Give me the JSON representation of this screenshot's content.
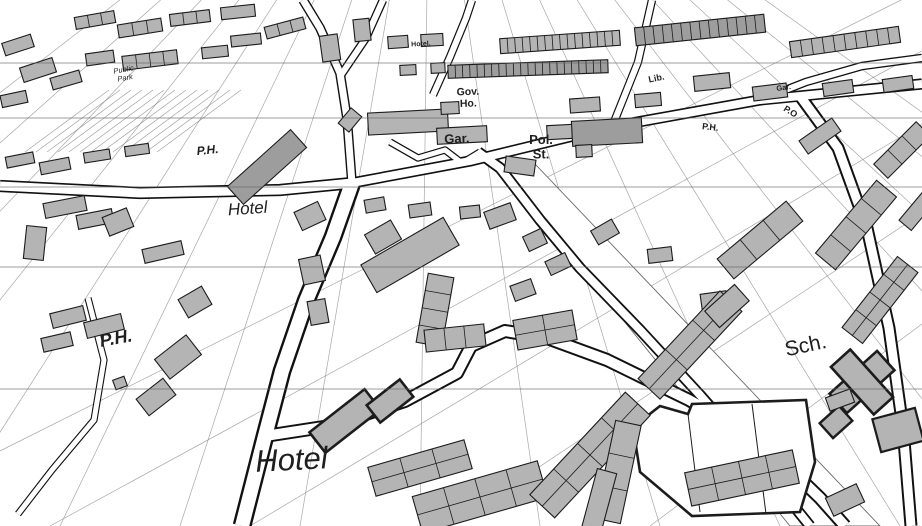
{
  "canvas": {
    "width": 922,
    "height": 526,
    "background": "#ffffff"
  },
  "colors": {
    "building_fill": "#b4b4b4",
    "building_fill_dark": "#9d9d9d",
    "building_stroke": "#1c1c1c",
    "road_casing": "#111111",
    "road_fill": "#ffffff",
    "parcel_line": "#8b8b8b",
    "grid_line": "#5f5f5f",
    "band_edge": "#6a6a6a",
    "label_dark": "#1f1f1f",
    "label_gray": "#3b3b3b"
  },
  "labels": [
    {
      "id": "public-park",
      "lines": [
        "Public",
        "Park"
      ],
      "x": 124,
      "y": 72,
      "size": 7.5,
      "rot": -10,
      "italic": true,
      "bold": false,
      "gray": true
    },
    {
      "id": "hotel-top",
      "lines": [
        "Hotel."
      ],
      "x": 421,
      "y": 46,
      "size": 7,
      "rot": -3,
      "italic": false,
      "bold": true,
      "gray": true
    },
    {
      "id": "gov-ho",
      "lines": [
        "Gov.",
        "Ho."
      ],
      "x": 468,
      "y": 95,
      "size": 10.5,
      "rot": -2,
      "italic": false,
      "bold": true,
      "gray": false
    },
    {
      "id": "lib",
      "lines": [
        "Lib."
      ],
      "x": 657,
      "y": 81,
      "size": 9,
      "rot": -12,
      "italic": false,
      "bold": true,
      "gray": false
    },
    {
      "id": "gar-small",
      "lines": [
        "Gar."
      ],
      "x": 784,
      "y": 90,
      "size": 7.5,
      "rot": -8,
      "italic": false,
      "bold": true,
      "gray": true
    },
    {
      "id": "po",
      "lines": [
        "P.O"
      ],
      "x": 789,
      "y": 114,
      "size": 9,
      "rot": 32,
      "italic": false,
      "bold": true,
      "gray": false
    },
    {
      "id": "ph-right",
      "lines": [
        "P.H."
      ],
      "x": 710,
      "y": 130,
      "size": 9,
      "rot": 6,
      "italic": false,
      "bold": true,
      "gray": false
    },
    {
      "id": "gar",
      "lines": [
        "Gar."
      ],
      "x": 457,
      "y": 143,
      "size": 13,
      "rot": -2,
      "italic": false,
      "bold": true,
      "gray": false
    },
    {
      "id": "pol-st",
      "lines": [
        "Pol.",
        "St."
      ],
      "x": 541,
      "y": 144,
      "size": 13,
      "rot": 0,
      "italic": false,
      "bold": true,
      "gray": false
    },
    {
      "id": "ph-left",
      "lines": [
        "P.H."
      ],
      "x": 208,
      "y": 154,
      "size": 12,
      "rot": -6,
      "italic": true,
      "bold": true,
      "gray": false
    },
    {
      "id": "hotel-mid",
      "lines": [
        "Hotel"
      ],
      "x": 248,
      "y": 214,
      "size": 17,
      "rot": -4,
      "italic": true,
      "bold": false,
      "gray": false
    },
    {
      "id": "ph-bottom",
      "lines": [
        "P.H."
      ],
      "x": 117,
      "y": 344,
      "size": 18,
      "rot": -10,
      "italic": true,
      "bold": true,
      "gray": false
    },
    {
      "id": "sch",
      "lines": [
        "Sch."
      ],
      "x": 807,
      "y": 352,
      "size": 21,
      "rot": -12,
      "italic": false,
      "bold": false,
      "gray": false
    },
    {
      "id": "hotel-bottom",
      "lines": [
        "Hotel"
      ],
      "x": 292,
      "y": 470,
      "size": 31,
      "rot": -3,
      "italic": true,
      "bold": false,
      "gray": false
    }
  ],
  "gridlines": [
    63,
    118,
    187,
    267,
    389
  ],
  "parcel_fan": {
    "vp": [
      430,
      -240
    ],
    "targets_y": 526,
    "targets_x": [
      -560,
      -430,
      -300,
      -180,
      -60,
      60,
      180,
      300,
      420,
      540,
      660,
      780,
      900,
      1020,
      1140,
      1260,
      1380,
      1500
    ]
  },
  "parcel_fan2": {
    "vp": [
      2300,
      -700
    ],
    "targets_y": 526,
    "targets_x": [
      -150,
      50,
      250,
      450,
      650
    ]
  },
  "park_stripes": {
    "x0": 25,
    "y0": 152,
    "dx": 84,
    "dy": -62,
    "count": 13,
    "step": 11
  },
  "band": {
    "pts": [
      [
        500,
        168
      ],
      [
        535,
        164
      ],
      [
        880,
        526
      ],
      [
        790,
        526
      ]
    ]
  },
  "roads": [
    {
      "pts": [
        [
          0,
          186
        ],
        [
          140,
          193
        ],
        [
          280,
          190
        ],
        [
          352,
          183
        ]
      ],
      "w": 9,
      "c": 1.6
    },
    {
      "pts": [
        [
          352,
          183
        ],
        [
          470,
          161
        ],
        [
          610,
          127
        ],
        [
          760,
          100
        ],
        [
          922,
          84
        ]
      ],
      "w": 8,
      "c": 1.6
    },
    {
      "pts": [
        [
          352,
          183
        ],
        [
          347,
          118
        ],
        [
          340,
          73
        ],
        [
          320,
          28
        ],
        [
          303,
          0
        ]
      ],
      "w": 7,
      "c": 1.4
    },
    {
      "pts": [
        [
          341,
          75
        ],
        [
          366,
          38
        ],
        [
          383,
          0
        ]
      ],
      "w": 6,
      "c": 1.3
    },
    {
      "pts": [
        [
          352,
          183
        ],
        [
          333,
          237
        ],
        [
          306,
          301
        ],
        [
          282,
          371
        ],
        [
          265,
          436
        ],
        [
          242,
          526
        ]
      ],
      "w": 14,
      "c": 2.4
    },
    {
      "pts": [
        [
          265,
          436
        ],
        [
          330,
          426
        ],
        [
          405,
          401
        ],
        [
          457,
          373
        ],
        [
          471,
          346
        ],
        [
          505,
          331
        ],
        [
          547,
          338
        ],
        [
          607,
          360
        ],
        [
          689,
          400
        ],
        [
          760,
          440
        ],
        [
          820,
          498
        ],
        [
          845,
          526
        ]
      ],
      "w": 10,
      "c": 2.0
    },
    {
      "pts": [
        [
          478,
          152
        ],
        [
          500,
          168
        ],
        [
          540,
          220
        ],
        [
          580,
          268
        ],
        [
          640,
          330
        ],
        [
          700,
          395
        ],
        [
          755,
          458
        ],
        [
          810,
          526
        ]
      ],
      "w": 8,
      "c": 1.8
    },
    {
      "pts": [
        [
          800,
          96
        ],
        [
          838,
          148
        ],
        [
          867,
          228
        ],
        [
          889,
          328
        ],
        [
          903,
          428
        ],
        [
          911,
          526
        ]
      ],
      "w": 9,
      "c": 2.0
    },
    {
      "pts": [
        [
          760,
          100
        ],
        [
          806,
          82
        ],
        [
          862,
          66
        ],
        [
          922,
          58
        ]
      ],
      "w": 6,
      "c": 1.3
    },
    {
      "pts": [
        [
          88,
          298
        ],
        [
          104,
          360
        ],
        [
          94,
          420
        ],
        [
          52,
          470
        ],
        [
          18,
          514
        ]
      ],
      "w": 5,
      "c": 1.1
    },
    {
      "pts": [
        [
          433,
          95
        ],
        [
          450,
          57
        ],
        [
          466,
          18
        ],
        [
          472,
          0
        ]
      ],
      "w": 6,
      "c": 1.2
    },
    {
      "pts": [
        [
          612,
          127
        ],
        [
          638,
          62
        ],
        [
          652,
          0
        ]
      ],
      "w": 6,
      "c": 1.2
    },
    {
      "pts": [
        [
          390,
          142
        ],
        [
          418,
          158
        ],
        [
          445,
          150
        ],
        [
          462,
          163
        ],
        [
          480,
          152
        ]
      ],
      "w": 5,
      "c": 1.2
    }
  ],
  "polygons": [
    {
      "pts": [
        [
          633,
          427
        ],
        [
          660,
          406
        ],
        [
          688,
          414
        ],
        [
          692,
          404
        ],
        [
          806,
          400
        ],
        [
          815,
          462
        ],
        [
          800,
          512
        ],
        [
          692,
          516
        ],
        [
          640,
          472
        ]
      ],
      "sw": 2.6,
      "inner": [
        [
          [
            688,
            414
          ],
          [
            700,
            512
          ]
        ],
        [
          [
            752,
            404
          ],
          [
            766,
            514
          ]
        ]
      ]
    }
  ],
  "buildings": [
    [
      18,
      45,
      30,
      13,
      -18
    ],
    [
      38,
      70,
      34,
      15,
      -18
    ],
    [
      14,
      99,
      26,
      12,
      -12
    ],
    [
      66,
      80,
      30,
      12,
      -16
    ],
    [
      95,
      20,
      40,
      12,
      -10,
      3
    ],
    [
      140,
      28,
      44,
      13,
      -9,
      3
    ],
    [
      190,
      18,
      40,
      12,
      -7,
      3
    ],
    [
      238,
      12,
      34,
      12,
      -6
    ],
    [
      150,
      60,
      55,
      14,
      -7,
      4
    ],
    [
      215,
      52,
      26,
      11,
      -6
    ],
    [
      246,
      40,
      30,
      11,
      -6
    ],
    [
      285,
      28,
      40,
      12,
      -15,
      3
    ],
    [
      100,
      58,
      28,
      12,
      -8
    ],
    [
      330,
      48,
      18,
      26,
      -8
    ],
    [
      362,
      30,
      16,
      22,
      -6
    ],
    [
      398,
      42,
      20,
      12,
      -4
    ],
    [
      432,
      40,
      22,
      12,
      -3
    ],
    [
      408,
      70,
      16,
      10,
      -3
    ],
    [
      438,
      68,
      14,
      10,
      -3
    ],
    [
      528,
      69,
      160,
      13,
      -2,
      22,
      1
    ],
    [
      560,
      42,
      120,
      15,
      -4,
      16
    ],
    [
      700,
      30,
      130,
      18,
      -6,
      14,
      1
    ],
    [
      845,
      42,
      110,
      16,
      -8,
      10
    ],
    [
      408,
      122,
      80,
      22,
      -3
    ],
    [
      450,
      108,
      18,
      12,
      -3
    ],
    [
      585,
      105,
      30,
      14,
      -4
    ],
    [
      648,
      100,
      26,
      13,
      -5
    ],
    [
      712,
      82,
      36,
      15,
      -6
    ],
    [
      770,
      92,
      34,
      14,
      -7
    ],
    [
      838,
      88,
      30,
      13,
      -8
    ],
    [
      898,
      84,
      30,
      13,
      -8
    ],
    [
      462,
      135,
      50,
      16,
      -3
    ],
    [
      560,
      132,
      26,
      14,
      -3
    ],
    [
      607,
      132,
      70,
      25,
      -3,
      0,
      1
    ],
    [
      584,
      151,
      16,
      12,
      -3
    ],
    [
      520,
      166,
      30,
      16,
      8
    ],
    [
      350,
      120,
      20,
      14,
      -50
    ],
    [
      267,
      167,
      85,
      24,
      -42,
      0,
      1
    ],
    [
      410,
      255,
      95,
      32,
      -30
    ],
    [
      383,
      237,
      30,
      22,
      -30
    ],
    [
      500,
      216,
      28,
      18,
      -20
    ],
    [
      535,
      240,
      20,
      16,
      -25
    ],
    [
      523,
      290,
      22,
      16,
      -20
    ],
    [
      605,
      232,
      24,
      16,
      -30
    ],
    [
      558,
      264,
      22,
      15,
      -25
    ],
    [
      660,
      255,
      24,
      14,
      -7
    ],
    [
      714,
      300,
      26,
      15,
      -8
    ],
    [
      310,
      216,
      26,
      20,
      -25
    ],
    [
      375,
      205,
      20,
      13,
      -10
    ],
    [
      420,
      210,
      22,
      13,
      -8
    ],
    [
      470,
      212,
      20,
      12,
      -6
    ],
    [
      20,
      160,
      28,
      11,
      -11
    ],
    [
      55,
      166,
      30,
      12,
      -11
    ],
    [
      97,
      156,
      26,
      10,
      -9
    ],
    [
      137,
      150,
      24,
      10,
      -8
    ],
    [
      65,
      207,
      42,
      15,
      -11
    ],
    [
      95,
      219,
      36,
      14,
      -11
    ],
    [
      35,
      243,
      20,
      33,
      6
    ],
    [
      118,
      222,
      26,
      20,
      -22
    ],
    [
      163,
      252,
      40,
      14,
      -13
    ],
    [
      195,
      302,
      27,
      21,
      -30
    ],
    [
      312,
      270,
      22,
      26,
      -12
    ],
    [
      318,
      312,
      18,
      24,
      -10
    ],
    [
      435,
      310,
      70,
      26,
      -80,
      4
    ],
    [
      455,
      338,
      60,
      22,
      -6,
      3
    ],
    [
      545,
      330,
      60,
      30,
      -10,
      2,
      0,
      1
    ],
    [
      68,
      317,
      34,
      15,
      -14
    ],
    [
      104,
      326,
      38,
      16,
      -14
    ],
    [
      57,
      342,
      30,
      14,
      -13
    ],
    [
      178,
      357,
      40,
      25,
      -38
    ],
    [
      156,
      397,
      34,
      21,
      -38
    ],
    [
      120,
      383,
      12,
      10,
      -20
    ],
    [
      420,
      468,
      100,
      30,
      -16,
      3,
      0,
      1
    ],
    [
      480,
      497,
      130,
      38,
      -16,
      4,
      0,
      1
    ],
    [
      345,
      421,
      70,
      26,
      -38,
      0,
      0,
      0,
      2.6
    ],
    [
      390,
      401,
      42,
      22,
      -38,
      0,
      0,
      0,
      2.6
    ],
    [
      590,
      455,
      140,
      34,
      -47,
      4,
      0,
      1
    ],
    [
      690,
      345,
      120,
      30,
      -47,
      3,
      0,
      1
    ],
    [
      618,
      472,
      100,
      26,
      -78,
      3
    ],
    [
      598,
      505,
      70,
      20,
      -75
    ],
    [
      760,
      240,
      90,
      26,
      -40,
      3
    ],
    [
      727,
      306,
      40,
      22,
      -42
    ],
    [
      856,
      225,
      95,
      26,
      -50,
      4
    ],
    [
      880,
      300,
      90,
      26,
      -52,
      4,
      0,
      1
    ],
    [
      902,
      150,
      60,
      20,
      -45,
      3
    ],
    [
      820,
      136,
      40,
      16,
      -35
    ],
    [
      918,
      210,
      40,
      16,
      -50
    ],
    [
      862,
      382,
      64,
      26,
      -42,
      0,
      0,
      0,
      2.6
    ],
    [
      862,
      382,
      26,
      64,
      -42,
      0,
      0,
      0,
      2.6
    ],
    [
      836,
      422,
      26,
      20,
      -42,
      0,
      0,
      0,
      2.4
    ],
    [
      898,
      430,
      44,
      34,
      -15,
      0,
      0,
      0,
      2.2
    ],
    [
      845,
      500,
      34,
      20,
      -25
    ],
    [
      840,
      400,
      26,
      14,
      -20
    ],
    [
      742,
      478,
      110,
      34,
      -12,
      4,
      0,
      1
    ]
  ]
}
